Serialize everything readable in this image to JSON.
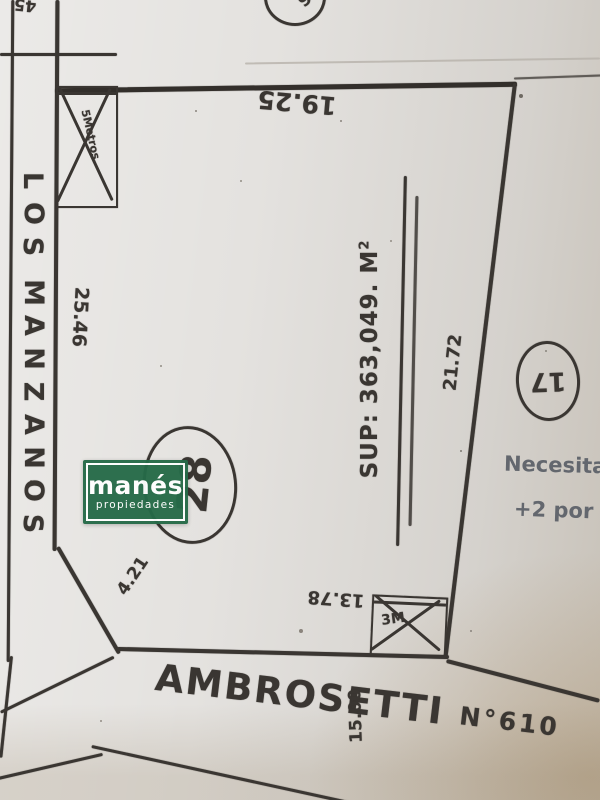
{
  "ink_color": "#3a3632",
  "pencil_color": "#63676e",
  "paper_color": "#e4e2df",
  "streets": {
    "left_name": "LOS MANZANOS",
    "bottom_name": "AMBROSETTI",
    "bottom_number": "N°610",
    "width_label": "15.00"
  },
  "lot": {
    "number": "28",
    "area": {
      "label": "SUP: 363,049.",
      "unit": "M",
      "superscript": "2"
    },
    "sides": {
      "top": "19.25",
      "right": "21.72",
      "left": "25.46",
      "bottom": "13.78",
      "corner_chamfer": "4.21"
    },
    "front_box_label": "5Metros.",
    "bottom_box_label": "3M"
  },
  "neighbors": {
    "right_lot_number": "17",
    "top_circle_label": "6",
    "top_left_label": "45"
  },
  "notes": {
    "line1": "Necesita",
    "line2": "+2 por"
  },
  "logo": {
    "title": "manés",
    "subtitle": "propiedades",
    "bg_color": "#266b48",
    "text_color": "#ffffff"
  }
}
